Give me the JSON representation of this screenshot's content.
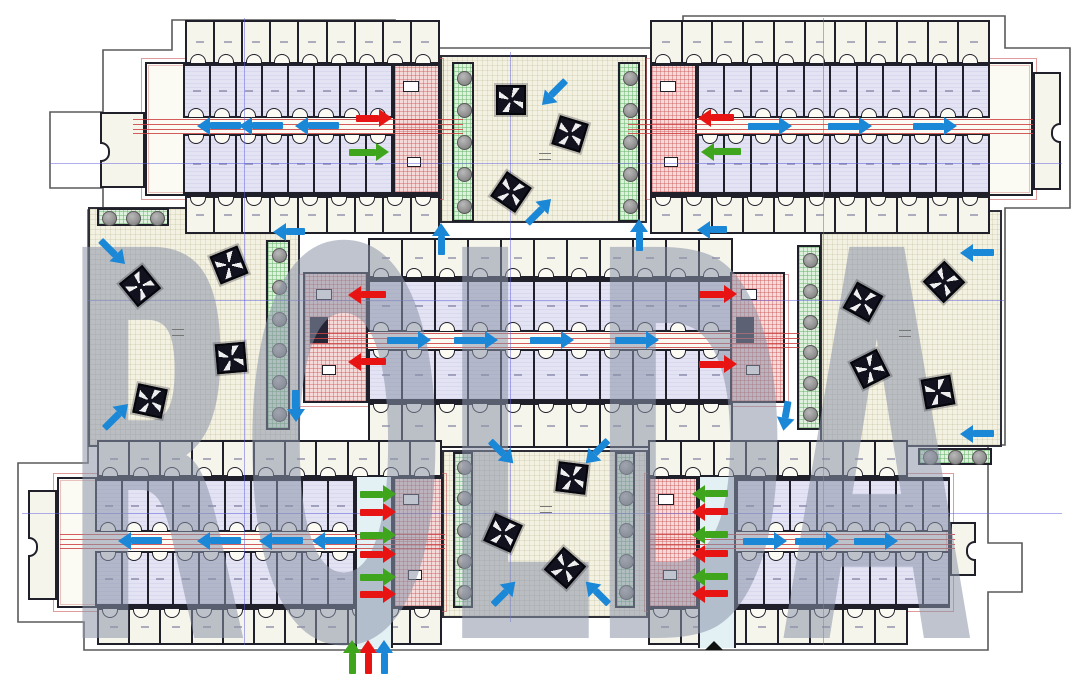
{
  "figure": {
    "type": "architectural-floor-plan",
    "description": "Shelter kennel complex ground plan with ventilation airflow arrows"
  },
  "watermark": {
    "text": "ROLDA",
    "color": "rgba(138,148,168,0.55)"
  },
  "colors": {
    "flow_blue": "#1b87d7",
    "flow_red": "#e81414",
    "flow_green": "#3fa51c",
    "wall": "#20202b",
    "courtyard_floor": "#f3f1e2",
    "kennel_fill": "#e3e3f3",
    "core_pink": "#f5dada",
    "planter_green": "#dff0df",
    "corridor_cyan": "#e3f1f5",
    "duct_red": "rgba(205,65,65,0.85)",
    "axis_blue": "rgba(95,95,225,0.5)"
  },
  "floorplan": {
    "courtyards": [
      {
        "id": "top-center",
        "x": 440,
        "y": 55,
        "w": 207,
        "h": 168
      },
      {
        "id": "left",
        "x": 88,
        "y": 207,
        "w": 212,
        "h": 240
      },
      {
        "id": "right",
        "x": 820,
        "y": 210,
        "w": 182,
        "h": 237
      },
      {
        "id": "bottom-center",
        "x": 442,
        "y": 450,
        "w": 206,
        "h": 168
      }
    ],
    "wings": [
      {
        "id": "top-left",
        "outer_top": [
          185,
          20,
          255,
          44,
          9
        ],
        "main": [
          145,
          62,
          295,
          134
        ],
        "inner_top": [
          183,
          64,
          210,
          54,
          8
        ],
        "inner_bottom": [
          183,
          134,
          210,
          60,
          8
        ],
        "outer_bottom": [
          185,
          196,
          255,
          38,
          9
        ]
      },
      {
        "id": "top-right",
        "outer_top": [
          650,
          20,
          340,
          44,
          11
        ],
        "main": [
          650,
          62,
          383,
          134
        ],
        "inner_top": [
          697,
          64,
          293,
          54,
          11
        ],
        "inner_bottom": [
          697,
          134,
          293,
          60,
          11
        ],
        "outer_bottom": [
          650,
          196,
          340,
          38,
          11
        ]
      },
      {
        "id": "central",
        "outer_top": [
          368,
          238,
          365,
          40,
          11
        ],
        "main": [
          303,
          278,
          482,
          125
        ],
        "inner_top": [
          368,
          280,
          365,
          52,
          11
        ],
        "inner_bottom": [
          368,
          349,
          365,
          52,
          11
        ],
        "outer_bottom": [
          368,
          403,
          365,
          45,
          11
        ]
      },
      {
        "id": "bottom-left",
        "outer_top": [
          97,
          440,
          345,
          37,
          11
        ],
        "main": [
          57,
          477,
          386,
          131
        ],
        "inner_top": [
          95,
          479,
          260,
          53,
          10
        ],
        "inner_bottom": [
          95,
          551,
          260,
          55,
          10
        ],
        "outer_bottom": [
          97,
          608,
          345,
          37,
          11
        ]
      },
      {
        "id": "bottom-right",
        "outer_top": [
          648,
          440,
          260,
          37,
          8
        ],
        "main": [
          648,
          477,
          302,
          131
        ],
        "inner_top": [
          736,
          479,
          214,
          53,
          8
        ],
        "inner_bottom": [
          736,
          551,
          214,
          55,
          8
        ],
        "outer_bottom": [
          648,
          608,
          260,
          37,
          8
        ]
      }
    ],
    "stair_cores": [
      {
        "x": 393,
        "y": 64,
        "w": 47,
        "h": 130,
        "lift": false
      },
      {
        "x": 650,
        "y": 64,
        "w": 47,
        "h": 130,
        "lift": false
      },
      {
        "x": 303,
        "y": 272,
        "w": 65,
        "h": 131,
        "lift": true
      },
      {
        "x": 730,
        "y": 272,
        "w": 55,
        "h": 131,
        "lift": true
      },
      {
        "x": 393,
        "y": 477,
        "w": 50,
        "h": 131,
        "lift": false
      },
      {
        "x": 648,
        "y": 477,
        "w": 50,
        "h": 131,
        "lift": false
      }
    ],
    "vertical_corridors": [
      {
        "x": 355,
        "y": 477,
        "w": 38,
        "h": 171
      },
      {
        "x": 698,
        "y": 477,
        "w": 38,
        "h": 171
      }
    ],
    "endcaps": [
      {
        "x": 100,
        "y": 112,
        "w": 45,
        "h": 76,
        "side": "l"
      },
      {
        "x": 1033,
        "y": 72,
        "w": 28,
        "h": 118,
        "side": "r"
      },
      {
        "x": 28,
        "y": 490,
        "w": 29,
        "h": 110,
        "side": "l"
      },
      {
        "x": 950,
        "y": 522,
        "w": 26,
        "h": 54,
        "side": "r"
      }
    ],
    "planters": [
      {
        "x": 452,
        "y": 62,
        "w": 22,
        "h": 160,
        "trees": 5,
        "orient": "v"
      },
      {
        "x": 618,
        "y": 62,
        "w": 22,
        "h": 160,
        "trees": 5,
        "orient": "v"
      },
      {
        "x": 266,
        "y": 240,
        "w": 24,
        "h": 190,
        "trees": 6,
        "orient": "v"
      },
      {
        "x": 797,
        "y": 245,
        "w": 24,
        "h": 185,
        "trees": 6,
        "orient": "v"
      },
      {
        "x": 453,
        "y": 452,
        "w": 20,
        "h": 156,
        "trees": 5,
        "orient": "v"
      },
      {
        "x": 615,
        "y": 452,
        "w": 20,
        "h": 156,
        "trees": 5,
        "orient": "v"
      },
      {
        "x": 97,
        "y": 208,
        "w": 72,
        "h": 18,
        "trees": 3,
        "orient": "h"
      },
      {
        "x": 918,
        "y": 448,
        "w": 74,
        "h": 17,
        "trees": 3,
        "orient": "h"
      }
    ],
    "fans": [
      [
        511,
        100
      ],
      [
        570,
        134
      ],
      [
        511,
        192
      ],
      [
        140,
        286
      ],
      [
        229,
        265
      ],
      [
        231,
        358
      ],
      [
        150,
        401
      ],
      [
        863,
        302
      ],
      [
        944,
        282
      ],
      [
        870,
        369
      ],
      [
        938,
        392
      ],
      [
        572,
        478
      ],
      [
        503,
        533
      ],
      [
        565,
        568
      ]
    ],
    "duct_lines": [
      {
        "x": 133,
        "w": 330,
        "cy": 126
      },
      {
        "x": 628,
        "w": 405,
        "cy": 126
      },
      {
        "x": 310,
        "w": 490,
        "cy": 340
      },
      {
        "x": 60,
        "w": 385,
        "cy": 541
      },
      {
        "x": 650,
        "w": 305,
        "cy": 541
      }
    ],
    "axis_lines": {
      "vertical": [
        [
          244,
          18,
          645
        ],
        [
          510,
          52,
          622
        ],
        [
          823,
          18,
          645
        ]
      ],
      "horizontal": [
        [
          163,
          50,
          1062
        ],
        [
          300,
          88,
          1004
        ],
        [
          513,
          22,
          1062
        ]
      ]
    },
    "arrows": {
      "blue": [
        [
          219,
          126,
          180,
          44
        ],
        [
          261,
          126,
          180,
          44
        ],
        [
          317,
          126,
          180,
          44
        ],
        [
          770,
          126,
          0,
          44
        ],
        [
          850,
          126,
          0,
          44
        ],
        [
          935,
          126,
          0,
          44
        ],
        [
          409,
          340,
          0,
          44
        ],
        [
          476,
          340,
          0,
          44
        ],
        [
          552,
          340,
          0,
          44
        ],
        [
          637,
          340,
          0,
          44
        ],
        [
          140,
          541,
          180,
          44
        ],
        [
          219,
          541,
          180,
          44
        ],
        [
          281,
          541,
          180,
          44
        ],
        [
          334,
          541,
          180,
          44
        ],
        [
          765,
          541,
          0,
          44
        ],
        [
          817,
          541,
          0,
          44
        ],
        [
          876,
          541,
          0,
          44
        ],
        [
          554,
          93,
          135,
          34
        ],
        [
          539,
          211,
          -45,
          34
        ],
        [
          441,
          239,
          -90,
          32
        ],
        [
          639,
          235,
          -90,
          32
        ],
        [
          113,
          252,
          45,
          34
        ],
        [
          116,
          416,
          -45,
          34
        ],
        [
          289,
          232,
          180,
          32
        ],
        [
          296,
          406,
          90,
          32
        ],
        [
          977,
          253,
          180,
          34
        ],
        [
          977,
          434,
          180,
          34
        ],
        [
          786,
          416,
          100,
          30
        ],
        [
          712,
          230,
          180,
          30
        ],
        [
          502,
          452,
          45,
          32
        ],
        [
          597,
          452,
          135,
          32
        ],
        [
          504,
          593,
          -45,
          32
        ],
        [
          597,
          593,
          225,
          32
        ],
        [
          384,
          657,
          -90,
          34
        ]
      ],
      "red": [
        [
          374,
          118,
          0,
          36
        ],
        [
          716,
          118,
          180,
          36
        ],
        [
          367,
          295,
          180,
          38
        ],
        [
          367,
          362,
          180,
          38
        ],
        [
          718,
          294,
          0,
          38
        ],
        [
          718,
          364,
          0,
          38
        ],
        [
          378,
          512,
          0,
          36
        ],
        [
          378,
          554,
          0,
          36
        ],
        [
          378,
          594,
          0,
          36
        ],
        [
          710,
          512,
          180,
          36
        ],
        [
          710,
          554,
          180,
          36
        ],
        [
          710,
          594,
          180,
          36
        ],
        [
          368,
          657,
          -90,
          34
        ]
      ],
      "green": [
        [
          369,
          152,
          0,
          40
        ],
        [
          721,
          152,
          180,
          40
        ],
        [
          378,
          494,
          0,
          36
        ],
        [
          378,
          535,
          0,
          36
        ],
        [
          378,
          577,
          0,
          36
        ],
        [
          710,
          494,
          180,
          36
        ],
        [
          710,
          535,
          180,
          36
        ],
        [
          710,
          577,
          180,
          36
        ],
        [
          352,
          657,
          -90,
          34
        ]
      ]
    },
    "marks": [
      [
        545,
        155
      ],
      [
        178,
        331
      ],
      [
        905,
        332
      ],
      [
        546,
        508
      ]
    ],
    "entrance_marker": {
      "x": 714,
      "y": 641
    },
    "boundary_path": "M172,20 H395 V48 H683 V16 H1005 V48 H1070 V208 H1005 V445 H988 V543 H1022 V592 H988 V650 H84 V622 H18 V463 H88 V210 H103 V188 H50 V112 H103 V50 H172 Z"
  }
}
